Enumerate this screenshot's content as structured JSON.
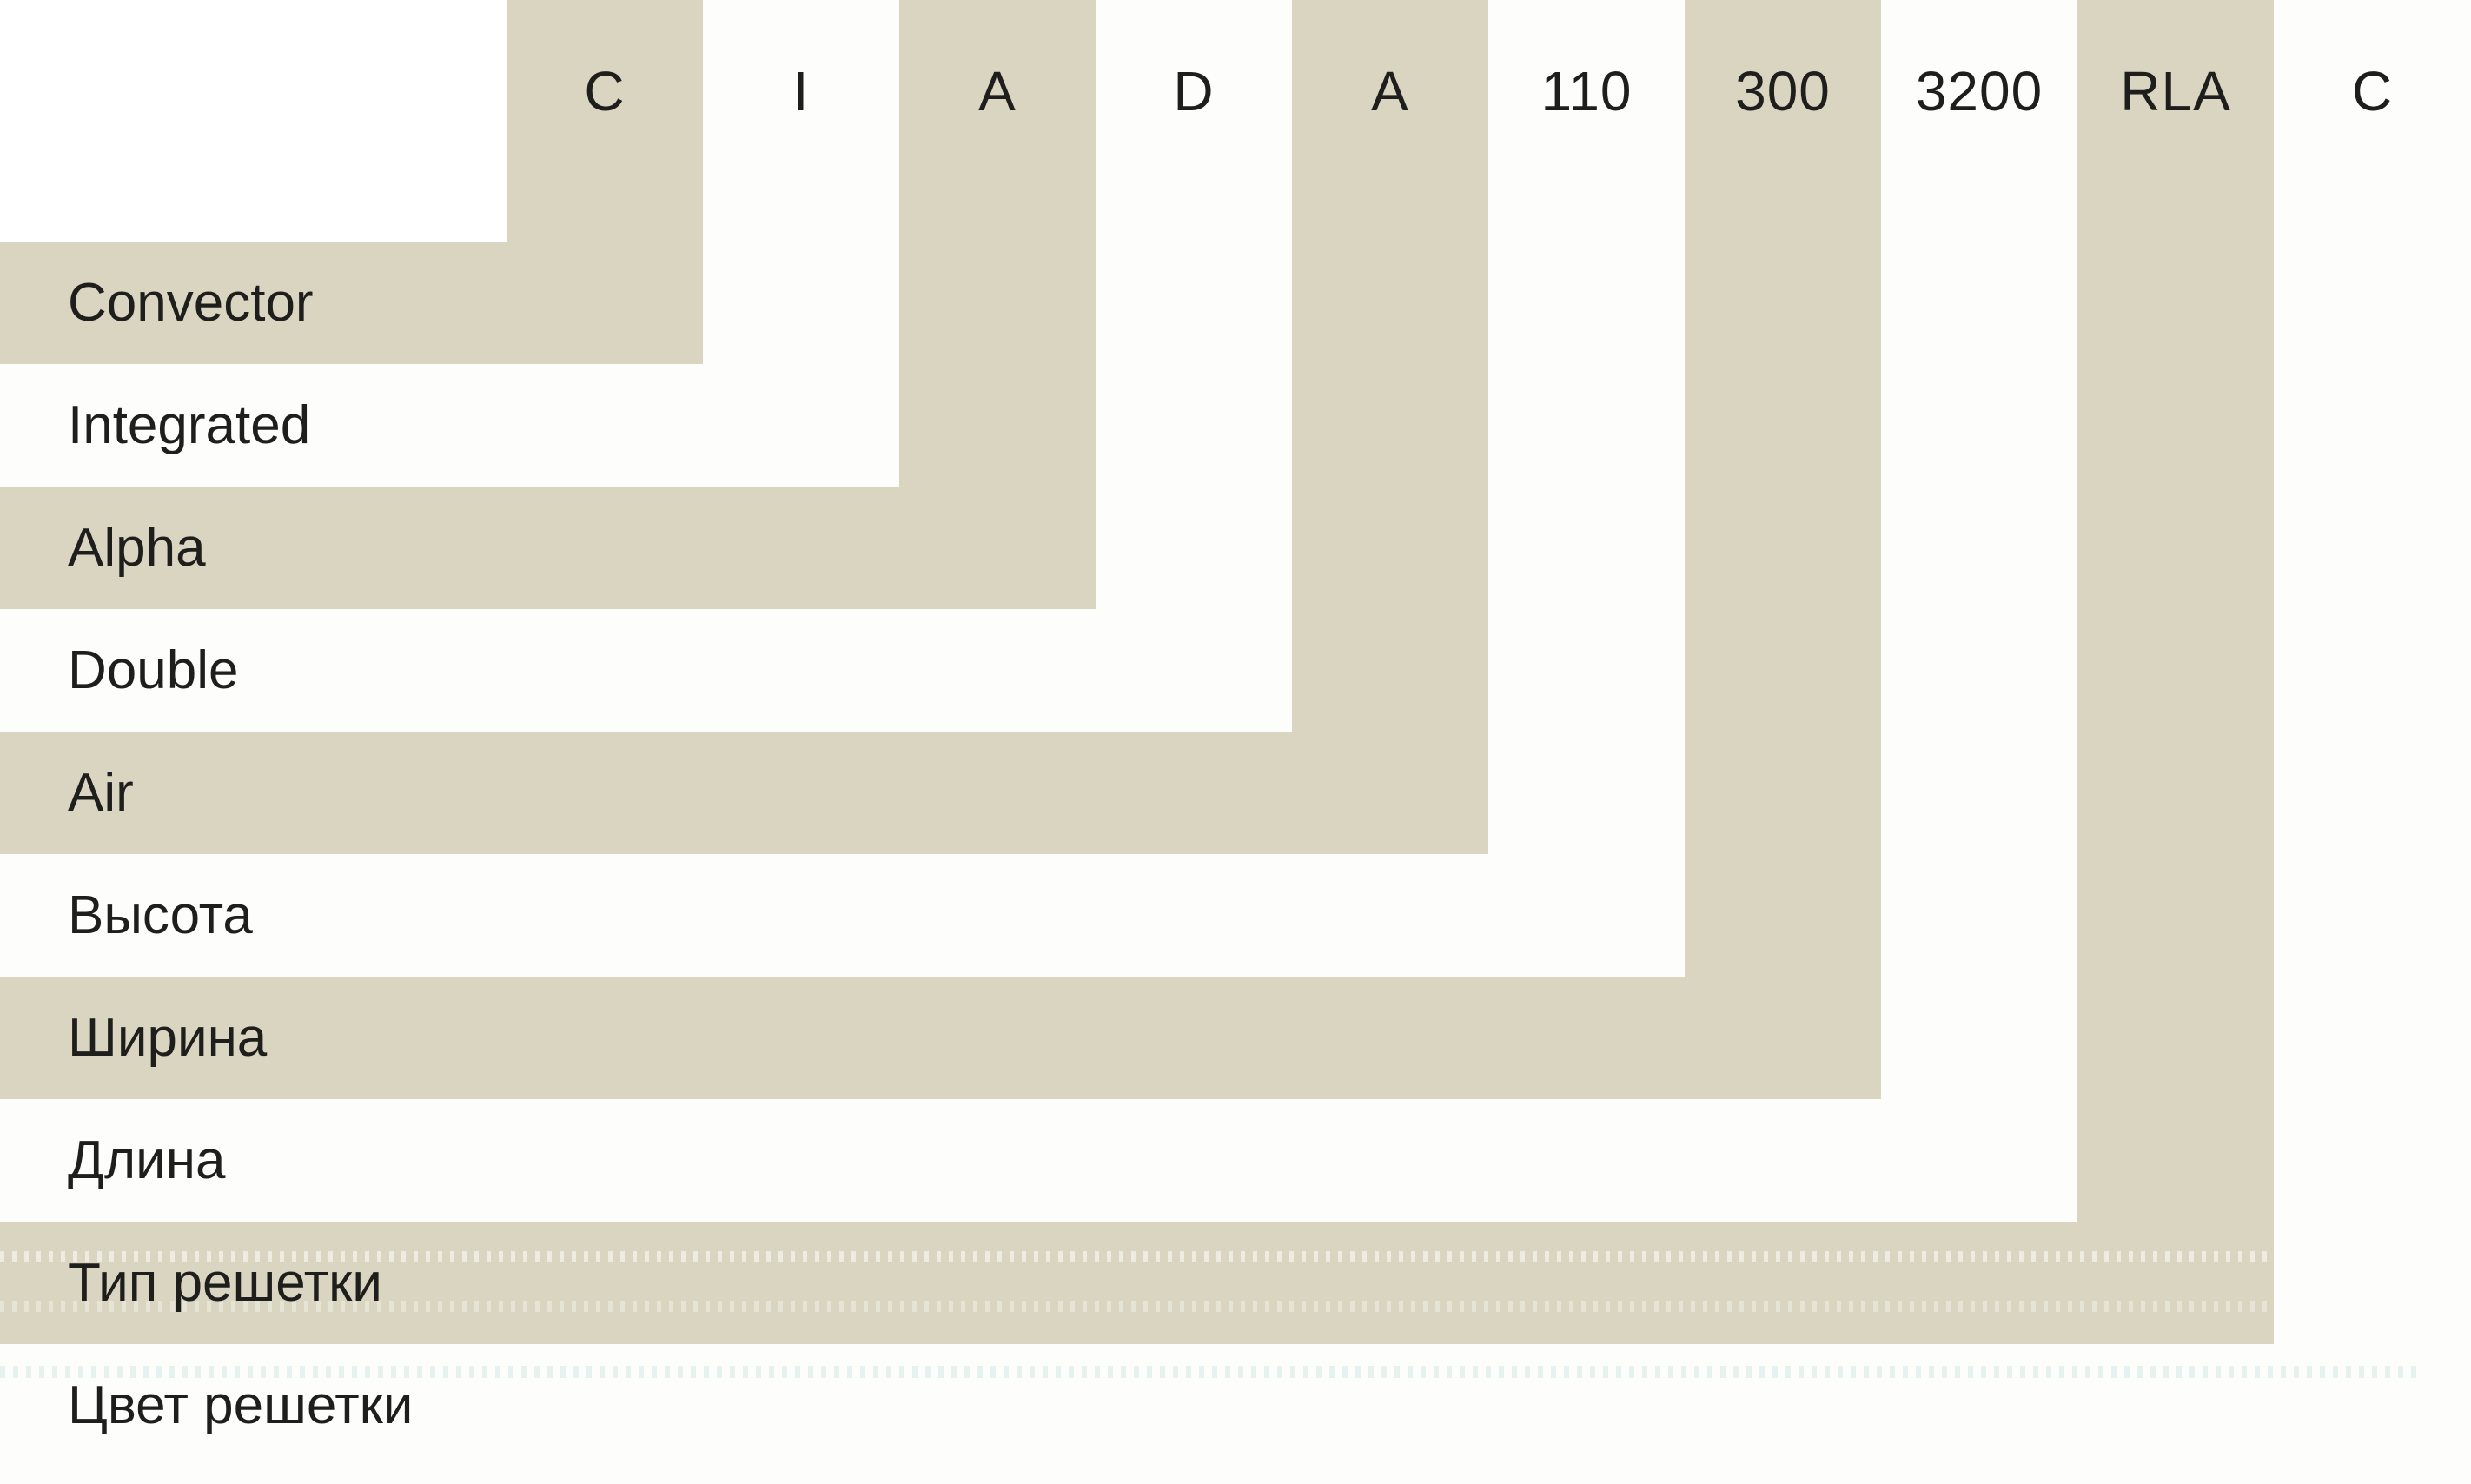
{
  "diagram": {
    "items": [
      {
        "code": "C",
        "label": "Convector",
        "band": "beige"
      },
      {
        "code": "I",
        "label": "Integrated",
        "band": "white"
      },
      {
        "code": "A",
        "label": "Alpha",
        "band": "beige"
      },
      {
        "code": "D",
        "label": "Double",
        "band": "white"
      },
      {
        "code": "A",
        "label": "Air",
        "band": "beige"
      },
      {
        "code": "110",
        "label": "Высота",
        "band": "white"
      },
      {
        "code": "300",
        "label": "Ширина",
        "band": "beige"
      },
      {
        "code": "3200",
        "label": "Длина",
        "band": "white"
      },
      {
        "code": "RLA",
        "label": "Тип решетки",
        "band": "beige"
      },
      {
        "code": "C",
        "label": "Цвет решетки",
        "band": "white"
      }
    ],
    "colors": {
      "band_beige": "#d9d5c0",
      "background": "#ffffff",
      "text": "#1e1e1c"
    }
  }
}
